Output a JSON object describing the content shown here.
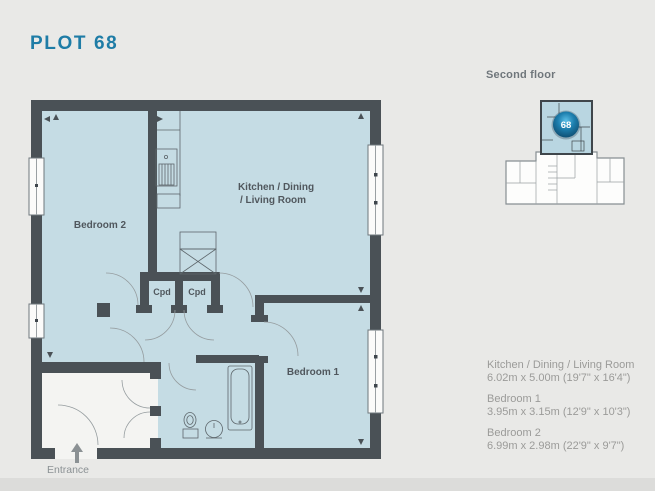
{
  "page": {
    "title": "PLOT 68"
  },
  "key_plan": {
    "label": "Second floor",
    "badge": "68"
  },
  "rooms": {
    "bedroom2": "Bedroom 2",
    "kitchen_line1": "Kitchen / Dining",
    "kitchen_line2": "/ Living Room",
    "bedroom1": "Bedroom 1",
    "cpd1": "Cpd",
    "cpd2": "Cpd",
    "entrance": "Entrance"
  },
  "dims": [
    {
      "name": "Kitchen / Dining / Living Room",
      "size": "6.02m x 5.00m (19'7\" x 16'4\")"
    },
    {
      "name": "Bedroom 1",
      "size": "3.95m x 3.15m (12'9\" x 10'3\")"
    },
    {
      "name": "Bedroom 2",
      "size": "6.99m x 2.98m (22'9\" x 9'7\")"
    }
  ],
  "colors": {
    "accent": "#1e7ca6",
    "room_fill": "#c5dce4",
    "wall": "#4a5156",
    "badge": "#1d7fae",
    "muted_text": "#9b9b99"
  }
}
